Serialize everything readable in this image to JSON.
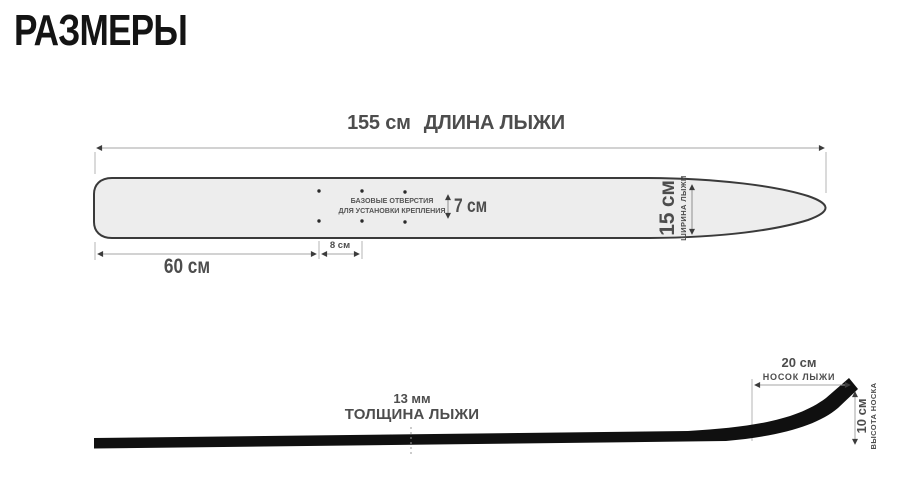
{
  "title": "РАЗМЕРЫ",
  "colors": {
    "label_text": "#4d4d4d",
    "dimension_line": "#a6a6a6",
    "arrowhead": "#3c3c3c",
    "ski_fill": "#ededed",
    "ski_outline": "#3a3a3a",
    "side_profile": "#101010",
    "background": "#ffffff"
  },
  "top_view": {
    "length_value": "155 см",
    "length_caption": "ДЛИНА ЛЫЖИ",
    "holes_note_line1": "БАЗОВЫЕ ОТВЕРСТИЯ",
    "holes_note_line2": "ДЛЯ УСТАНОВКИ КРЕПЛЕНИЯ",
    "holes_row_gap": "7 см",
    "holes_col_gap": "8 см",
    "tail_to_holes": "60 см",
    "width_value": "15 см",
    "width_caption": "ШИРИНА ЛЫЖИ"
  },
  "side_view": {
    "thickness_value": "13 мм",
    "thickness_caption": "ТОЛЩИНА ЛЫЖИ",
    "tip_length_value": "20 см",
    "tip_length_caption": "НОСОК ЛЫЖИ",
    "tip_height_value": "10 см",
    "tip_height_caption": "ВЫСОТА НОСКА"
  }
}
